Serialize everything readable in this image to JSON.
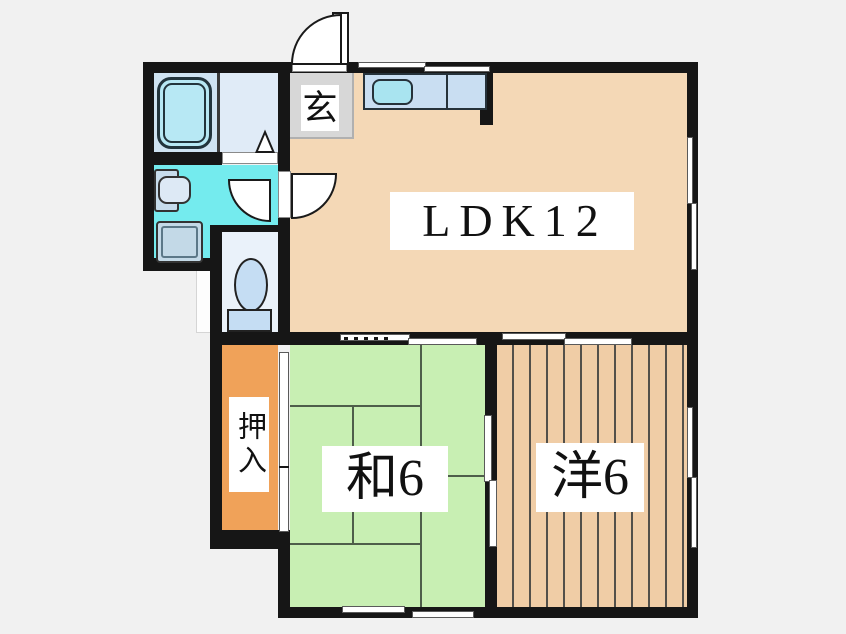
{
  "page": {
    "type": "japanese-apartment-floorplan",
    "background_color": "#f1f1f1",
    "wall_color": "#161616"
  },
  "labels": {
    "ldk": "LDK12",
    "japanese_room": "和6",
    "western_room": "洋6",
    "closet": "押入",
    "entrance": "玄"
  },
  "rooms": [
    {
      "name": "living-dining-kitchen",
      "label": "LDK12",
      "size_mats": 12,
      "floor_color": "#f4d8b6"
    },
    {
      "name": "japanese-room",
      "label": "和6",
      "size_mats": 6,
      "floor_color": "#c8efb3"
    },
    {
      "name": "western-room",
      "label": "洋6",
      "size_mats": 6,
      "floor_color": "#f0cda6"
    },
    {
      "name": "closet-oshiire",
      "label": "押入",
      "floor_color": "#f0a259"
    },
    {
      "name": "entrance-genkan",
      "label": "玄",
      "floor_color": "#d7d7d7"
    },
    {
      "name": "washroom",
      "floor_color": "#74ebee"
    },
    {
      "name": "bathroom",
      "floor_color": "#cfe3f2"
    },
    {
      "name": "toilet-room",
      "floor_color": "#eaf2fa"
    }
  ],
  "fixtures": [
    "bathtub",
    "washbasin",
    "washing-machine-pan",
    "toilet",
    "kitchen-counter",
    "kitchen-sink",
    "entrance-door-swing",
    "hall-door-swing",
    "bathroom-folding-door",
    "sliding-doors",
    "windows"
  ],
  "accent_colors": {
    "fixture_blue": "#c5ddf3",
    "sink_cyan": "#a9e4f0",
    "tub_cyan": "#b7e8f4",
    "tatami_line": "#4e5e4a"
  }
}
